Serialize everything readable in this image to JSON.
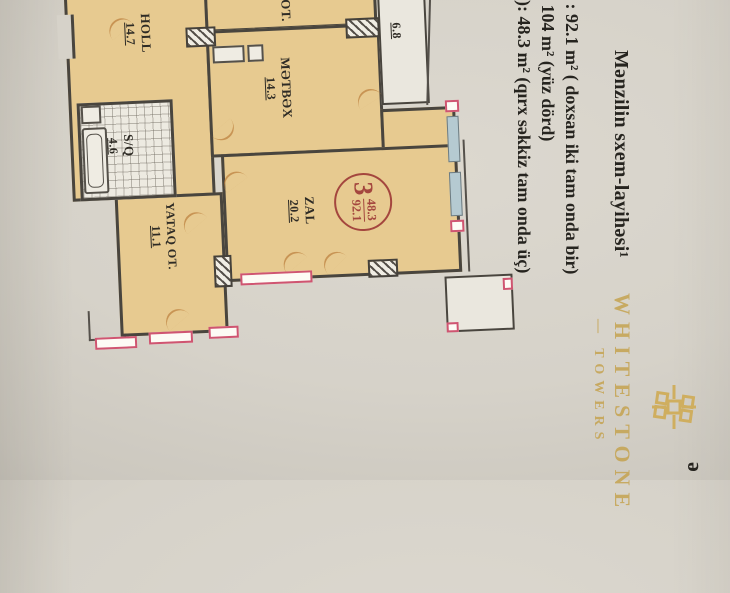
{
  "document": {
    "title": "Mənzilin sxem-layihəsi¹",
    "line_total": "i :  92.1 m² ( doxsan iki tam onda bir)",
    "line_gross": ":  104 m² (yüz dörd)",
    "line_living": "ə): 48.3 m² (qırx səkkiz tam onda üç)",
    "corner_note": "ə"
  },
  "plan": {
    "rooms": {
      "ot": {
        "name": "OT.",
        "area": ""
      },
      "holl": {
        "name": "HOLL",
        "area": "14.7"
      },
      "sq": {
        "name": "S/Q",
        "area": "4.6"
      },
      "yataq": {
        "name": "YATAQ OT.",
        "area": "11.1"
      },
      "metbex": {
        "name": "MƏTBƏX",
        "area": "14.3"
      },
      "zal": {
        "name": "ZAL",
        "area": "20.2"
      },
      "balcony": {
        "name": "",
        "area": "6.8"
      }
    },
    "stamp": {
      "number": "3",
      "numerator": "48.3",
      "denominator": "92.1"
    }
  },
  "watermark": {
    "brand": "WHITESTONE",
    "sub": "— TOWERS"
  },
  "colors": {
    "paper": "#d6d2c9",
    "room_fill": "#e7ca90",
    "walls": "#49453e",
    "stamp_red": "#a4463e",
    "window_pink": "#cf5571",
    "window_blue": "#b5cad1",
    "watermark_gold": "#c5a350",
    "ink": "#26241f"
  }
}
